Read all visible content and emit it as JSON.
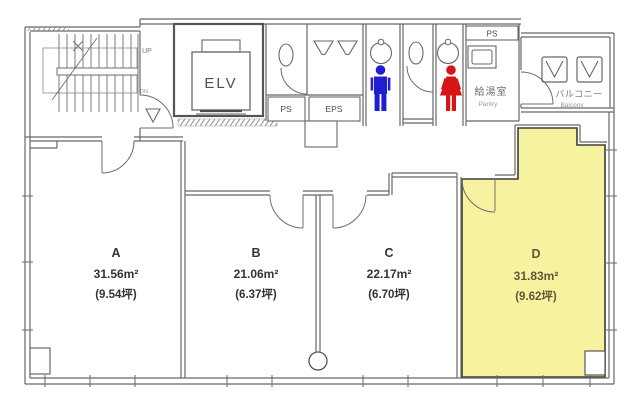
{
  "plan": {
    "highlighted_room": "D",
    "rooms": [
      {
        "name": "A",
        "area": "31.56m²",
        "tsubo": "(9.54坪)"
      },
      {
        "name": "B",
        "area": "21.06m²",
        "tsubo": "(6.37坪)"
      },
      {
        "name": "C",
        "area": "22.17m²",
        "tsubo": "(6.70坪)"
      },
      {
        "name": "D",
        "area": "31.83m²",
        "tsubo": "(9.62坪)"
      }
    ],
    "labels": {
      "elevator": "ELV",
      "up": "UP",
      "down": "DN",
      "ps": "PS",
      "eps": "EPS",
      "ps_pantry": "PS",
      "pantry_jp": "給湯室",
      "pantry_en": "Pantry",
      "balcony_jp": "バルコニー",
      "balcony_en": "Balcony"
    },
    "colors": {
      "highlight": "#f6f2a0",
      "wall": "#676767",
      "male_icon": "#1f1fd0",
      "female_icon": "#d61616"
    }
  }
}
